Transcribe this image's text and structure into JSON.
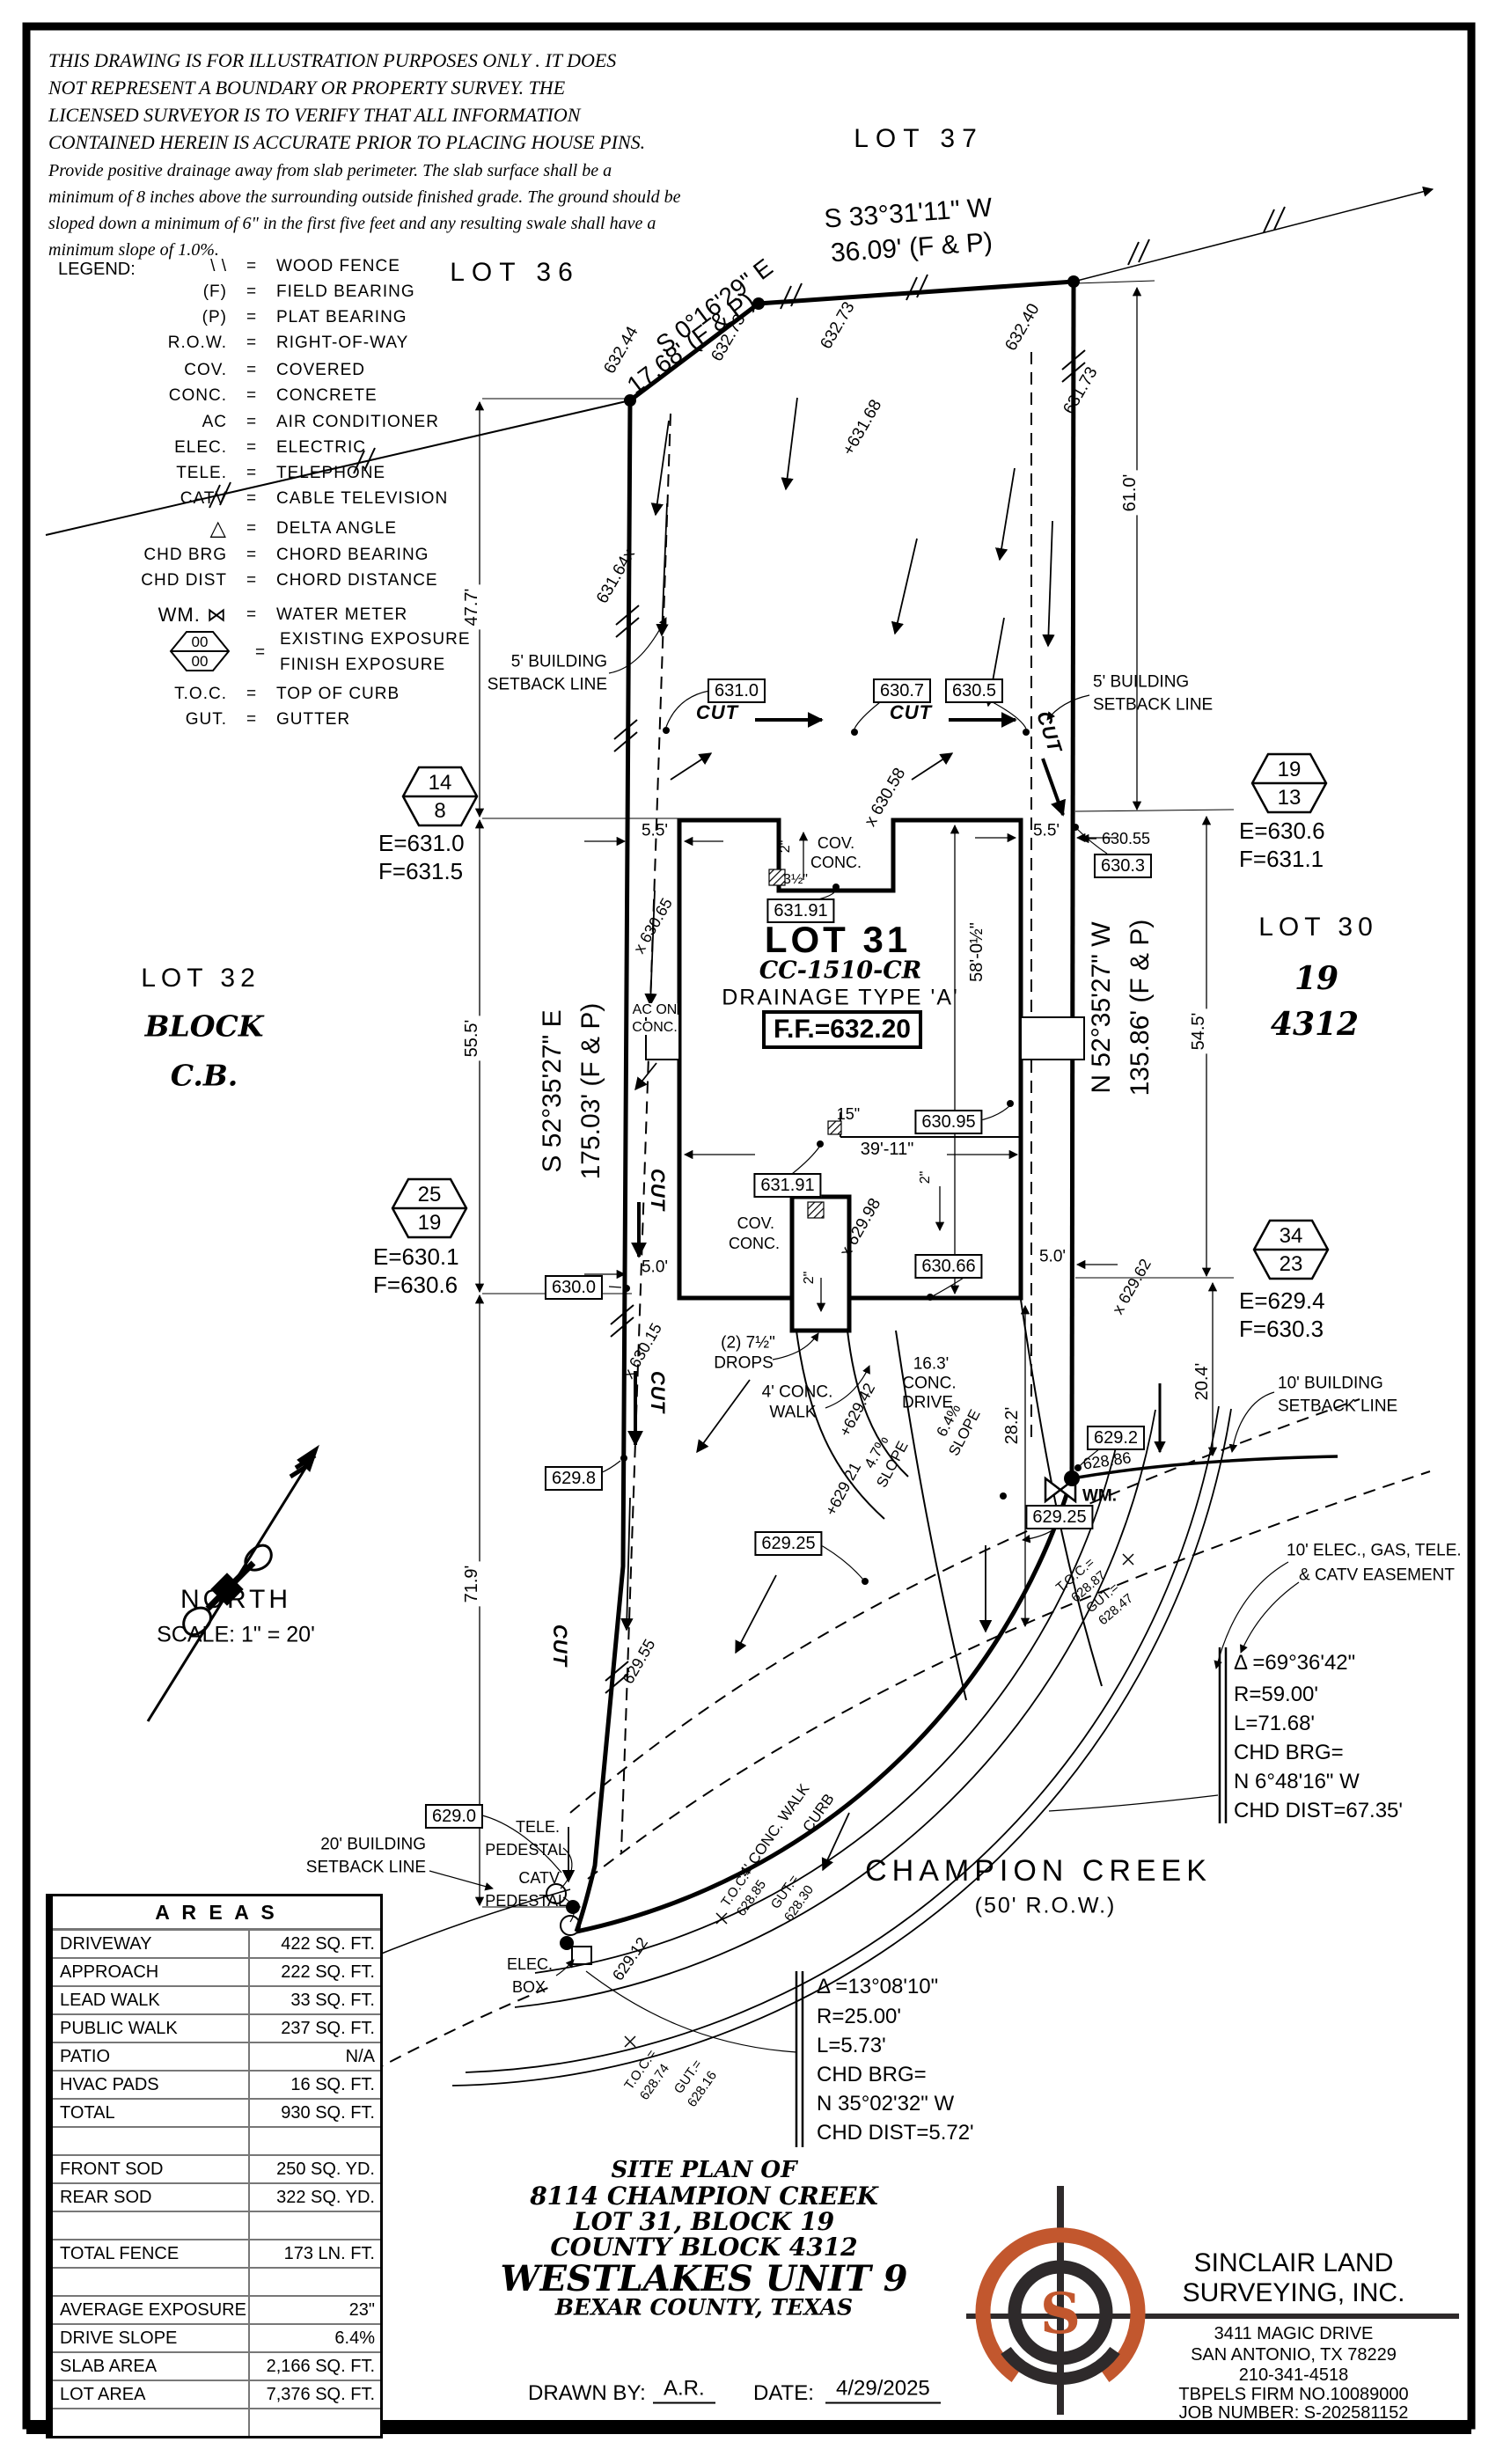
{
  "disclaimer": {
    "line1": "THIS DRAWING IS FOR ILLUSTRATION PURPOSES ONLY . IT DOES",
    "line2": "NOT REPRESENT A BOUNDARY OR PROPERTY SURVEY. THE",
    "line3": "LICENSED SURVEYOR IS TO VERIFY THAT ALL INFORMATION",
    "line4": "CONTAINED HEREIN IS ACCURATE PRIOR TO PLACING HOUSE PINS.",
    "line5": "Provide positive drainage away from slab perimeter. The slab surface shall be a",
    "line6": "minimum of 8 inches above the surrounding outside finished grade. The ground should be",
    "line7": "sloped down a minimum of 6\" in the first five feet and any resulting swale shall have a",
    "line8": "minimum slope of 1.0%."
  },
  "legend": {
    "title": "LEGEND:",
    "eq": "=",
    "rows": [
      {
        "sym": "\\ \\",
        "desc": "WOOD FENCE"
      },
      {
        "sym": "(F)",
        "desc": "FIELD BEARING"
      },
      {
        "sym": "(P)",
        "desc": "PLAT BEARING"
      },
      {
        "sym": "R.O.W.",
        "desc": "RIGHT-OF-WAY"
      },
      {
        "sym": "COV.",
        "desc": "COVERED"
      },
      {
        "sym": "CONC.",
        "desc": "CONCRETE"
      },
      {
        "sym": "AC",
        "desc": "AIR CONDITIONER"
      },
      {
        "sym": "ELEC.",
        "desc": "ELECTRIC"
      },
      {
        "sym": "TELE.",
        "desc": "TELEPHONE"
      },
      {
        "sym": "CATV",
        "desc": "CABLE TELEVISION"
      },
      {
        "sym": "△",
        "desc": "DELTA ANGLE"
      },
      {
        "sym": "CHD BRG",
        "desc": "CHORD BEARING"
      },
      {
        "sym": "CHD DIST",
        "desc": "CHORD DISTANCE"
      },
      {
        "sym": "WM. ⋈",
        "desc": "WATER METER"
      }
    ],
    "exposure": {
      "top": "00",
      "bottom": "00",
      "desc1": "EXISTING EXPOSURE",
      "desc2": "FINISH EXPOSURE"
    },
    "toc": {
      "sym": "T.O.C.",
      "desc": "TOP OF CURB"
    },
    "gut": {
      "sym": "GUT.",
      "desc": "GUTTER"
    }
  },
  "lots": {
    "lot36": "LOT 36",
    "lot37": "LOT 37",
    "lot32": "LOT 32",
    "lot32_block": "BLOCK",
    "lot32_cb": "C.B.",
    "lot30": "LOT 30",
    "lot30_block": "19",
    "lot30_cb": "4312"
  },
  "site": {
    "lot31": "LOT 31",
    "cc": "CC-1510-CR",
    "drainage": "DRAINAGE TYPE 'A'",
    "ff": "F.F.=632.20"
  },
  "bearings": {
    "top1a": "S 33°31'11\" W",
    "top1b": "36.09'  (F & P)",
    "top2a": "S 0°16'29\" E",
    "top2b": "17.68'  (F & P)",
    "west_a": "S 52°35'27\" E",
    "west_b": "175.03' (F & P)",
    "east_a": "N 52°35'27\" W",
    "east_b": "135.86' (F & P)"
  },
  "dims": {
    "d477": "47.7'",
    "d555": "55.5'",
    "d719": "71.9'",
    "d610": "61.0'",
    "d545": "54.5'",
    "d204": "20.4'",
    "d282": "28.2'",
    "d55w": "5.5'",
    "d55e": "5.5'",
    "d50w": "5.0'",
    "d50e": "5.0'",
    "d5801": "58'-0½\"",
    "d3911": "39'-11\"",
    "d15": "15\"",
    "p2a": "2\"",
    "p2b": "2\"",
    "p2c": "2\"",
    "p35a": "3½\"",
    "p35b": "3½\""
  },
  "cut": "CUT",
  "boxes": {
    "b6310": "631.0",
    "b6307": "630.7",
    "b6305": "630.5",
    "b63191a": "631.91",
    "b63191b": "631.91",
    "b63095": "630.95",
    "b63066": "630.66",
    "b6300": "630.0",
    "b6298": "629.8",
    "b6303": "630.3",
    "b6292": "629.2",
    "b62925a": "629.25",
    "b62925b": "629.25",
    "b6290": "629.0"
  },
  "spots": {
    "s63244": "632.44",
    "s63273a": "632.73",
    "s63273b": "632.73",
    "s63240": "632.40",
    "s63168": "+631.68",
    "s63173": "631.73",
    "s63164": "631.64x",
    "s63058": "x 630.58",
    "s63065": "x 630.65",
    "s63015": "x 630.15",
    "s62998": "x 629.98",
    "s62942": "+629.42",
    "s62921": "+629.21",
    "s62955": "629.55",
    "s62912": "629.12",
    "s62962": "x 629.62",
    "s62886": "628.86",
    "s63055": "630.55"
  },
  "labels": {
    "s5bldg_l1": "5' BUILDING",
    "s5bldg_l2": "SETBACK LINE",
    "s5bldg_r1": "5' BUILDING",
    "s5bldg_r2": "SETBACK LINE",
    "s10bldg1": "10' BUILDING",
    "s10bldg2": "SETBACK LINE",
    "easement1": "10' ELEC., GAS, TELE.",
    "easement2": "& CATV EASEMENT",
    "s20bldg1": "20' BUILDING",
    "s20bldg2": "SETBACK LINE",
    "tele1": "TELE.",
    "tele2": "PEDESTAL",
    "catv1": "CATV",
    "catv2": "PEDESTAL",
    "elec1": "ELEC.",
    "elec2": "BOX",
    "wm": "WM.",
    "acon1": "AC ON",
    "acon2": "CONC.",
    "cov1a": "COV.",
    "cov1b": "CONC.",
    "cov2a": "COV.",
    "cov2b": "CONC.",
    "drops1": "(2) 7½\"",
    "drops2": "DROPS",
    "walk1": "4' CONC.",
    "walk2": "WALK",
    "drive1": "16.3'",
    "drive2": "CONC.",
    "drive3": "DRIVE",
    "slope1a": "4.7%",
    "slope1b": "SLOPE",
    "slope2a": "6.4%",
    "slope2b": "SLOPE",
    "walk_diag": "4' CONC. WALK",
    "curb_diag": "CURB",
    "toc1a": "T.O.C.=",
    "toc1b": "628.87",
    "gut1a": "GUT.=",
    "gut1b": "628.47",
    "toc2a": "T.O.C.=",
    "toc2b": "628.85",
    "gut2a": "GUT.=",
    "gut2b": "628.30",
    "toc3a": "T.O.C.=",
    "toc3b": "628.74",
    "gut3a": "GUT.=",
    "gut3b": "628.16"
  },
  "street": {
    "name": "CHAMPION CREEK",
    "row": "(50' R.O.W.)"
  },
  "curve1": {
    "l1": "Δ =69°36'42\"",
    "l2": "R=59.00'",
    "l3": "L=71.68'",
    "l4": "CHD BRG=",
    "l5": "N 6°48'16\" W",
    "l6": "CHD DIST=67.35'"
  },
  "curve2": {
    "l1": "Δ =13°08'10\"",
    "l2": "R=25.00'",
    "l3": "L=5.73'",
    "l4": "CHD BRG=",
    "l5": "N 35°02'32\" W",
    "l6": "CHD DIST=5.72'"
  },
  "north": {
    "label": "NORTH",
    "scale": "SCALE:  1\"  =  20'"
  },
  "hexes": {
    "h1top": "14",
    "h1bot": "8",
    "h1e": "E=631.0",
    "h1f": "F=631.5",
    "h2top": "19",
    "h2bot": "13",
    "h2e": "E=630.6",
    "h2f": "F=631.1",
    "h3top": "25",
    "h3bot": "19",
    "h3e": "E=630.1",
    "h3f": "F=630.6",
    "h4top": "34",
    "h4bot": "23",
    "h4e": "E=629.4",
    "h4f": "F=630.3"
  },
  "areas": {
    "title": "A R E A S",
    "rows": [
      {
        "label": "DRIVEWAY",
        "value": "422 SQ. FT."
      },
      {
        "label": "APPROACH",
        "value": "222 SQ. FT."
      },
      {
        "label": "LEAD WALK",
        "value": "33 SQ. FT."
      },
      {
        "label": "PUBLIC WALK",
        "value": "237 SQ. FT."
      },
      {
        "label": "PATIO",
        "value": "N/A"
      },
      {
        "label": "HVAC PADS",
        "value": "16 SQ. FT."
      },
      {
        "label": "TOTAL",
        "value": "930 SQ. FT."
      },
      {
        "label": "",
        "value": ""
      },
      {
        "label": "FRONT SOD",
        "value": "250 SQ. YD."
      },
      {
        "label": "REAR SOD",
        "value": "322 SQ. YD."
      },
      {
        "label": "",
        "value": ""
      },
      {
        "label": "TOTAL FENCE",
        "value": "173 LN. FT."
      },
      {
        "label": "",
        "value": ""
      },
      {
        "label": "AVERAGE EXPOSURE",
        "value": "23\""
      },
      {
        "label": "DRIVE SLOPE",
        "value": "6.4%"
      },
      {
        "label": "SLAB AREA",
        "value": "2,166 SQ. FT."
      },
      {
        "label": "LOT AREA",
        "value": "7,376 SQ. FT."
      },
      {
        "label": "",
        "value": ""
      }
    ]
  },
  "title_block": {
    "l1": "SITE  PLAN  OF",
    "l2": "8114  CHAMPION  CREEK",
    "l3": "LOT  31,  BLOCK  19",
    "l4": "COUNTY  BLOCK  4312",
    "l5": "WESTLAKES  UNIT  9",
    "l6": "BEXAR  COUNTY,  TEXAS",
    "drawn_label": "DRAWN  BY:",
    "drawn": "A.R.",
    "date_label": "DATE:",
    "date": "4/29/2025"
  },
  "company": {
    "name1": "SINCLAIR  LAND",
    "name2": "SURVEYING,  INC.",
    "addr1": "3411  MAGIC  DRIVE",
    "addr2": "SAN  ANTONIO,  TX  78229",
    "phone": "210-341-4518",
    "firm": "TBPELS  FIRM  NO.10089000",
    "job": "JOB  NUMBER:  S-202581152",
    "logo_letter": "S"
  },
  "colors": {
    "ink": "#000000",
    "logo_orange": "#C2572E",
    "logo_dark": "#2E2A2B"
  }
}
